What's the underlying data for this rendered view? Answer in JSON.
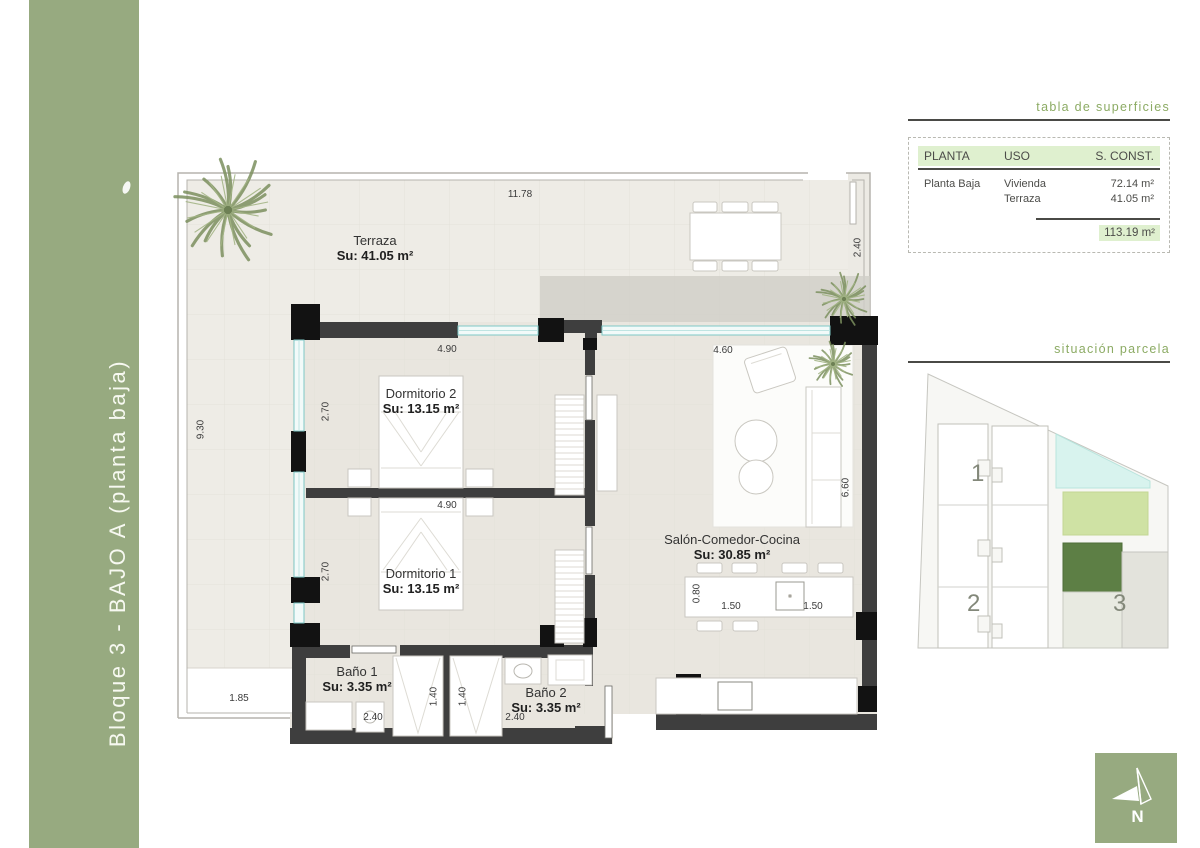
{
  "sidebar": {
    "title": "Bloque 3 - BAJO A (planta baja)"
  },
  "plan": {
    "rooms": [
      {
        "name": "Terraza",
        "area": "Su: 41.05 m²"
      },
      {
        "name": "Dormitorio 2",
        "area": "Su: 13.15 m²"
      },
      {
        "name": "Dormitorio 1",
        "area": "Su: 13.15 m²"
      },
      {
        "name": "Salón-Comedor-Cocina",
        "area": "Su: 30.85 m²"
      },
      {
        "name": "Baño 1",
        "area": "Su: 3.35 m²"
      },
      {
        "name": "Baño 2",
        "area": "Su: 3.35 m²"
      }
    ],
    "dimensions": {
      "terrace_top": "11.78",
      "terrace_right": "2.40",
      "terrace_left": "9.30",
      "terrace_bottom": "1.85",
      "dorm2_top": "4.90",
      "dorm2_left": "2.70",
      "dorm1_top": "4.90",
      "dorm1_left": "2.70",
      "salon_top": "4.60",
      "salon_right": "6.60",
      "island_depth": "0.80",
      "island_left": "1.50",
      "island_right": "1.50",
      "closet1": "1.40",
      "closet2": "1.40",
      "bath1_width": "2.40",
      "bath2_width": "2.40"
    }
  },
  "surfaces_table": {
    "title": "tabla de superficies",
    "col_planta": "PLANTA",
    "col_uso": "USO",
    "col_sconst": "S. CONST.",
    "rows": [
      {
        "planta": "Planta Baja",
        "uso": "Vivienda",
        "sconst": "72.14 m²"
      },
      {
        "planta": "",
        "uso": "Terraza",
        "sconst": "41.05 m²"
      }
    ],
    "total": "113.19 m²"
  },
  "site_plan": {
    "title": "situación parcela",
    "block1": "1",
    "block2": "2",
    "block3": "3"
  },
  "compass": {
    "north": "N"
  },
  "colors": {
    "accent_green": "#97aa80",
    "title_green": "#8cab64",
    "highlight_green": "#dff0cf",
    "selected_block": "#5d7f45",
    "pool": "#d8f3ee",
    "lawn": "#cfe2a4"
  }
}
